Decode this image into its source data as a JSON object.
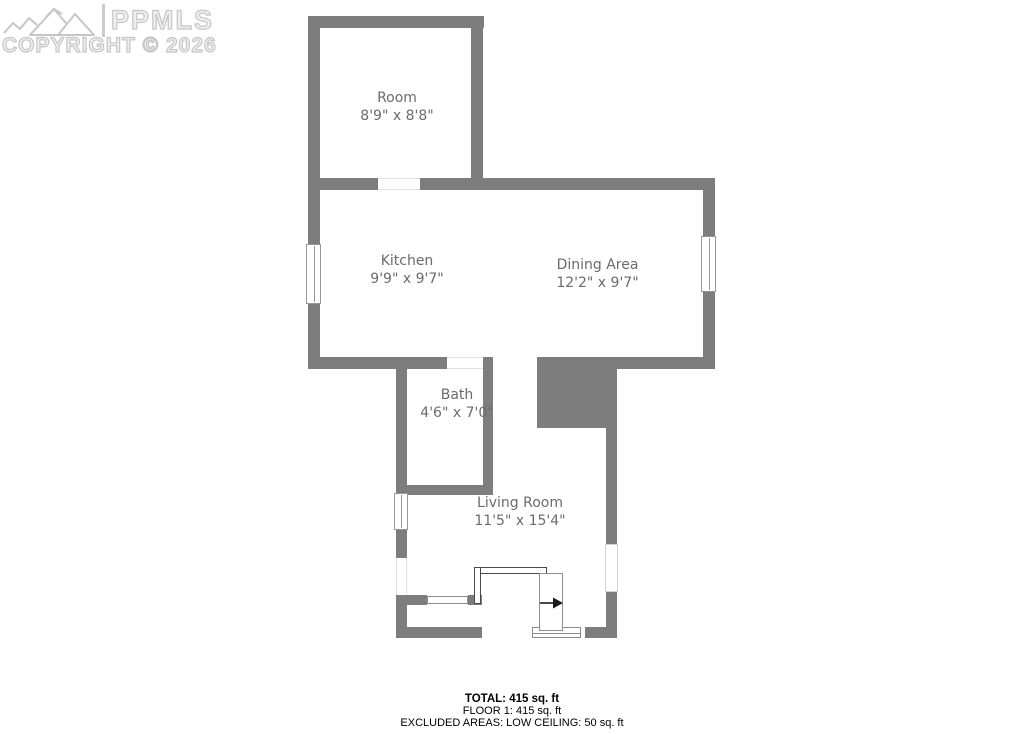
{
  "watermark": {
    "brand": "PPMLS",
    "copyright": "COPYRIGHT © 2026",
    "logo": "mountain-range-icon",
    "color": "#c6c6c6"
  },
  "floorplan": {
    "colors": {
      "wall": "#7d7d7d",
      "label": "#6b6b6b"
    },
    "rooms": [
      {
        "name": "Room",
        "dims": "8'9\" x 8'8\""
      },
      {
        "name": "Kitchen",
        "dims": "9'9\" x 9'7\""
      },
      {
        "name": "Dining Area",
        "dims": "12'2\" x 9'7\""
      },
      {
        "name": "Bath",
        "dims": "4'6\" x 7'0\""
      },
      {
        "name": "Living Room",
        "dims": "11'5\" x 15'4\""
      }
    ],
    "features": [
      "stairs-down-arrow",
      "stair-railing",
      "windows",
      "door-openings",
      "low-ceiling-solid-block"
    ]
  },
  "summary": {
    "total": "TOTAL: 415 sq. ft",
    "floor1": "FLOOR 1: 415 sq. ft",
    "excluded": "EXCLUDED AREAS: LOW CEILING: 50 sq. ft"
  }
}
